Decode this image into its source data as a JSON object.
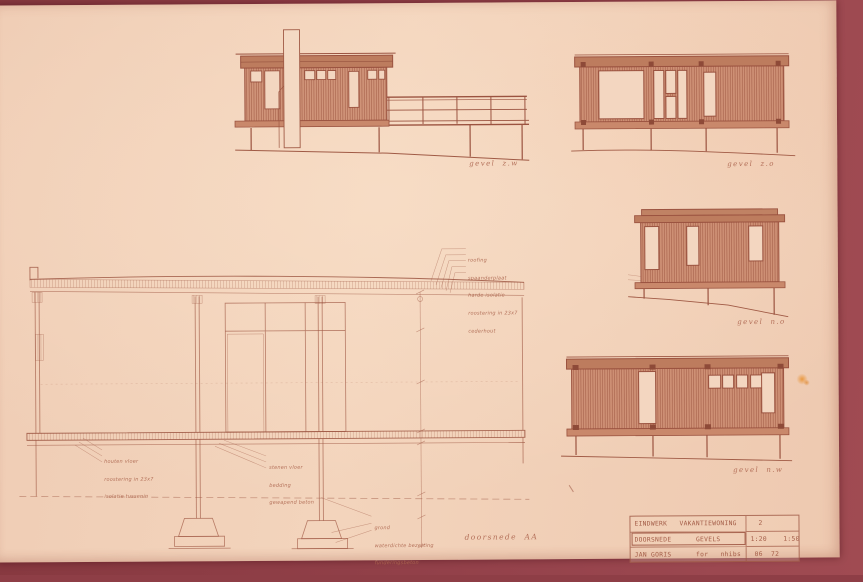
{
  "photo": {
    "mount_color": "#8e3e46",
    "paper_color": "#f2d1b8",
    "ink_color": "#9b5340"
  },
  "labels": {
    "elevation_sw": "gevel  z.w",
    "elevation_se": "gevel  z.o",
    "elevation_ne": "gevel  n.o",
    "elevation_nw": "gevel  n.w",
    "section": "doorsnede  AA"
  },
  "annotations": {
    "roof_buildup": [
      "roofing",
      "spaanderplaat",
      "harde isolatie",
      "roostering in 23x7",
      "cederhout"
    ],
    "wood_floor": [
      "houten vloer",
      "roostering in 23x7",
      "isolatie tussenin"
    ],
    "stone_floor": [
      "stenen vloer",
      "bedding",
      "gewapend beton"
    ],
    "foundation": [
      "grond",
      "waterdichte bezetting",
      "funderingsbeton"
    ]
  },
  "title_block": {
    "project": "EINDWERK   VAKANTIEWONING",
    "sheet_no": "2",
    "drawing": "DOORSNEDE      GEVELS",
    "scales": "1:20    1:50",
    "author": "JAN GORIS      for   nhibs",
    "date": "06  72"
  }
}
